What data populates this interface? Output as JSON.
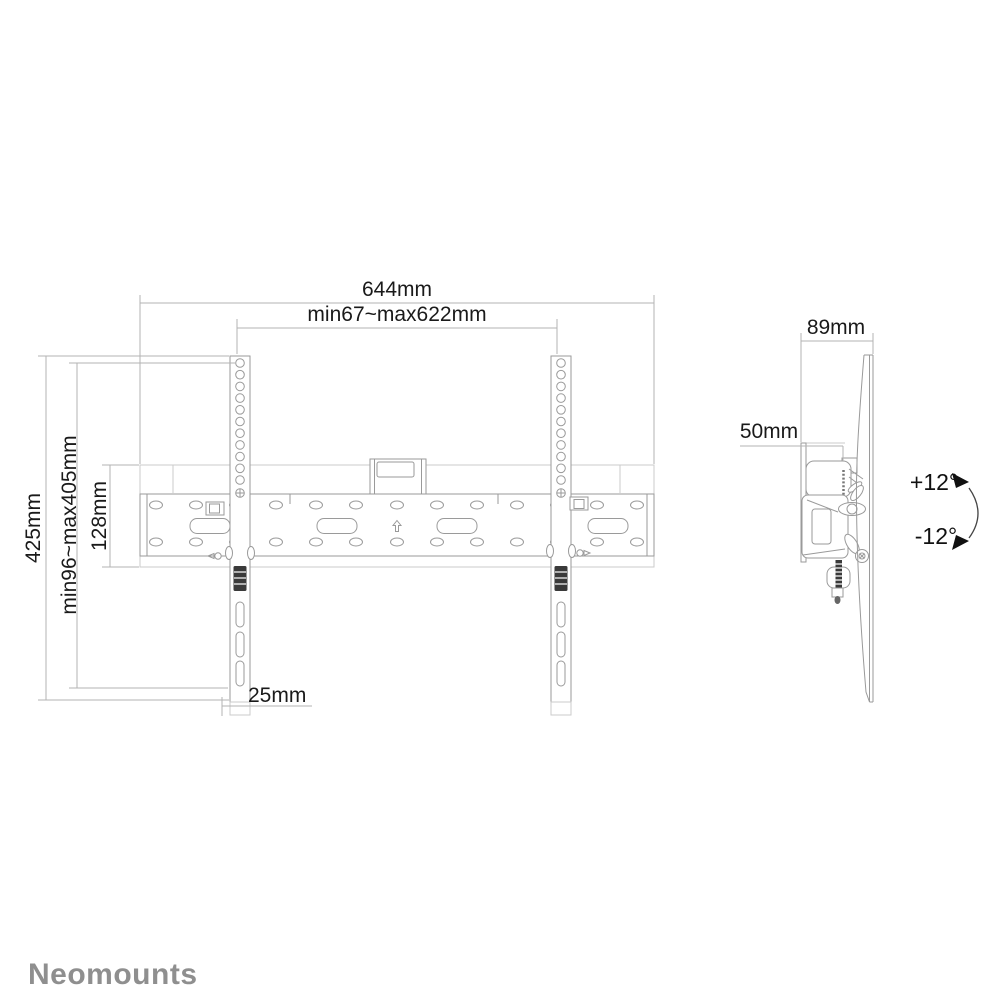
{
  "front_view": {
    "width_total": "644mm",
    "width_range": "min67~max622mm",
    "height_total": "425mm",
    "height_range": "min96~max405mm",
    "plate_height": "128mm",
    "bracket_width": "25mm"
  },
  "side_view": {
    "depth": "89mm",
    "offset": "50mm",
    "tilt_up": "+12°",
    "tilt_down": "-12°"
  },
  "brand": {
    "name": "Neomounts"
  },
  "colors": {
    "label_text": "#1a1a1a",
    "drawing_line": "#9a9a9a",
    "faint_line": "#cbcbcb",
    "dimension_line": "#b3b3b3",
    "brand_gray": "#8f8f8f"
  }
}
